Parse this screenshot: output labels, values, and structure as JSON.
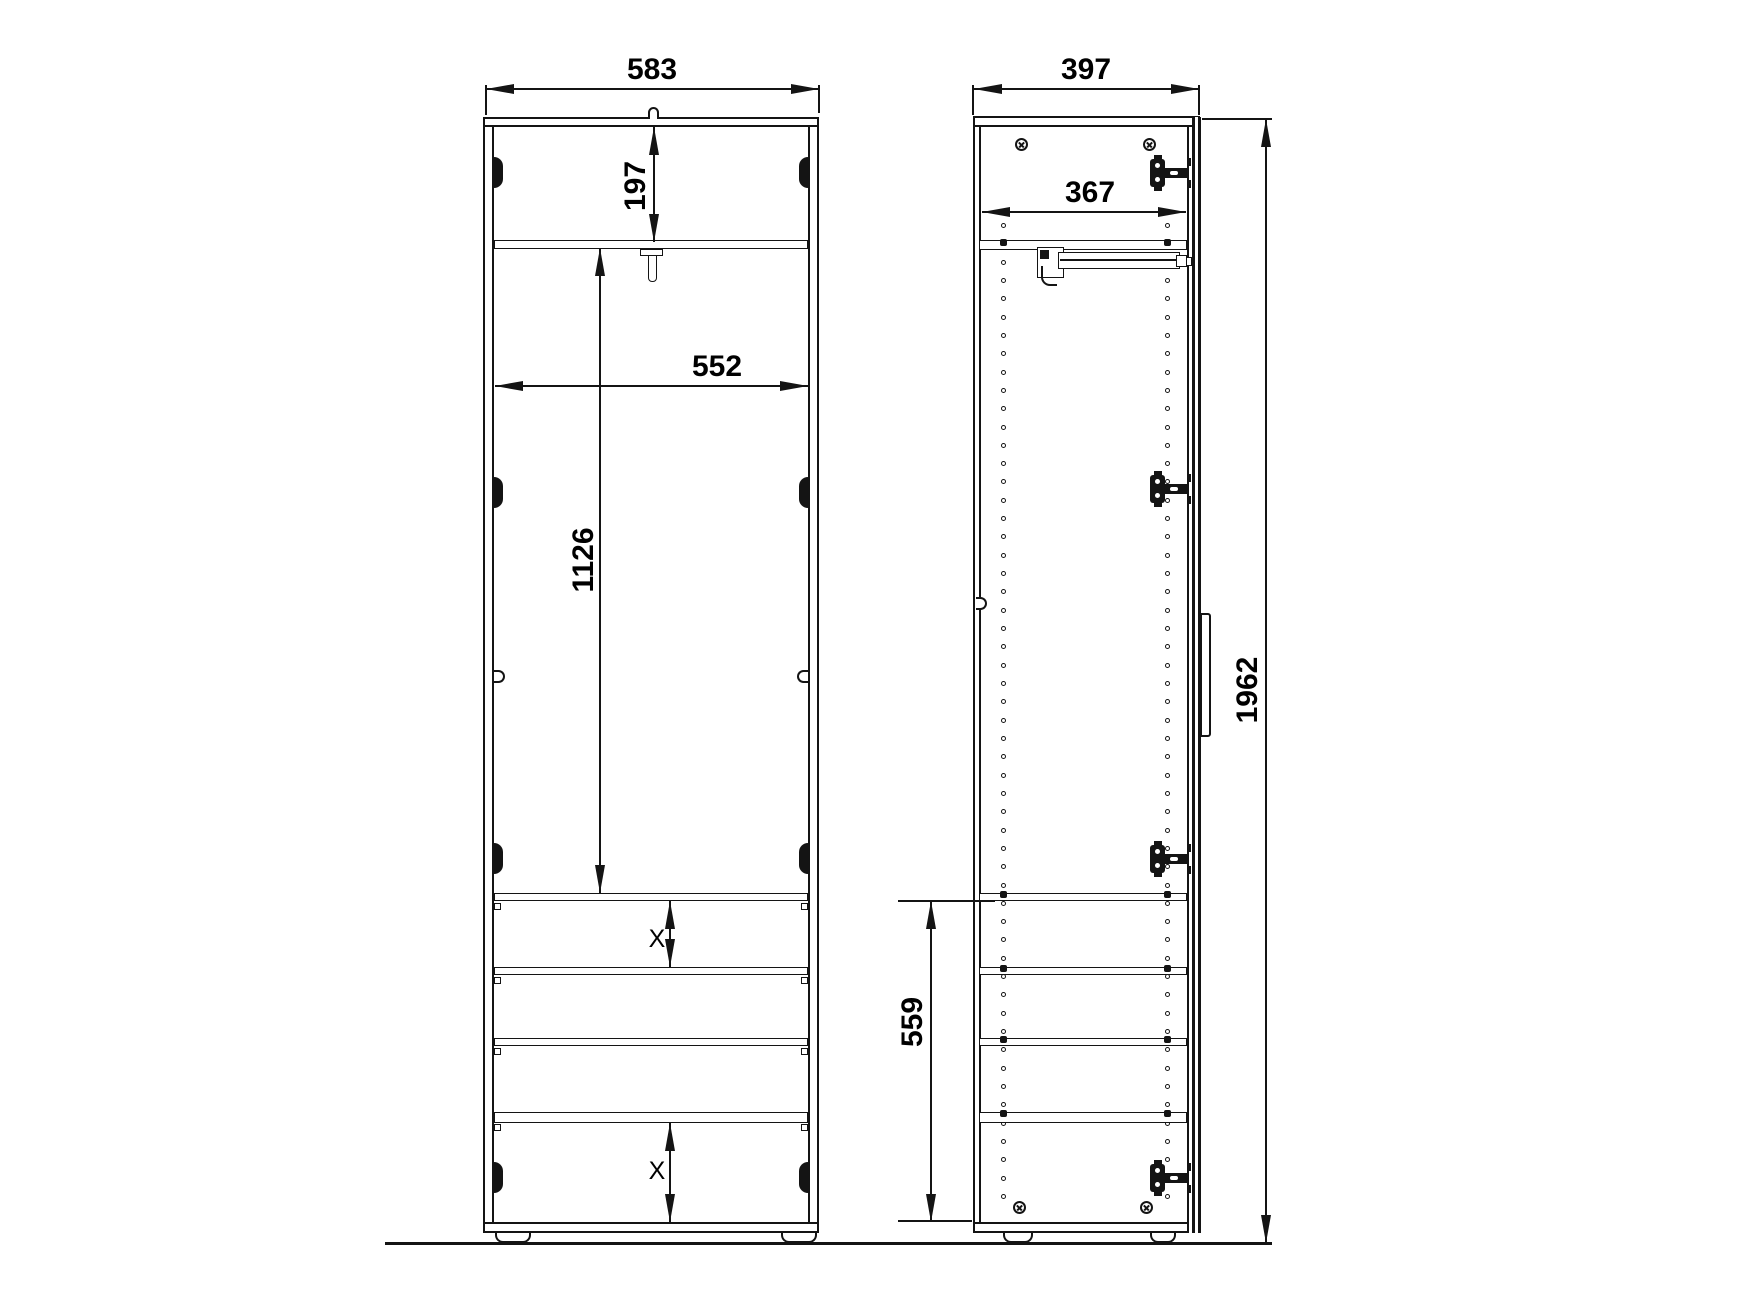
{
  "dimensions": {
    "front_width": "583",
    "cabinet_depth": "397",
    "top_section_height": "197",
    "interior_width": "552",
    "interior_height": "1126",
    "interior_depth": "367",
    "total_height": "1962",
    "lower_section_height": "559",
    "gap_upper": "X",
    "gap_lower": "X"
  }
}
